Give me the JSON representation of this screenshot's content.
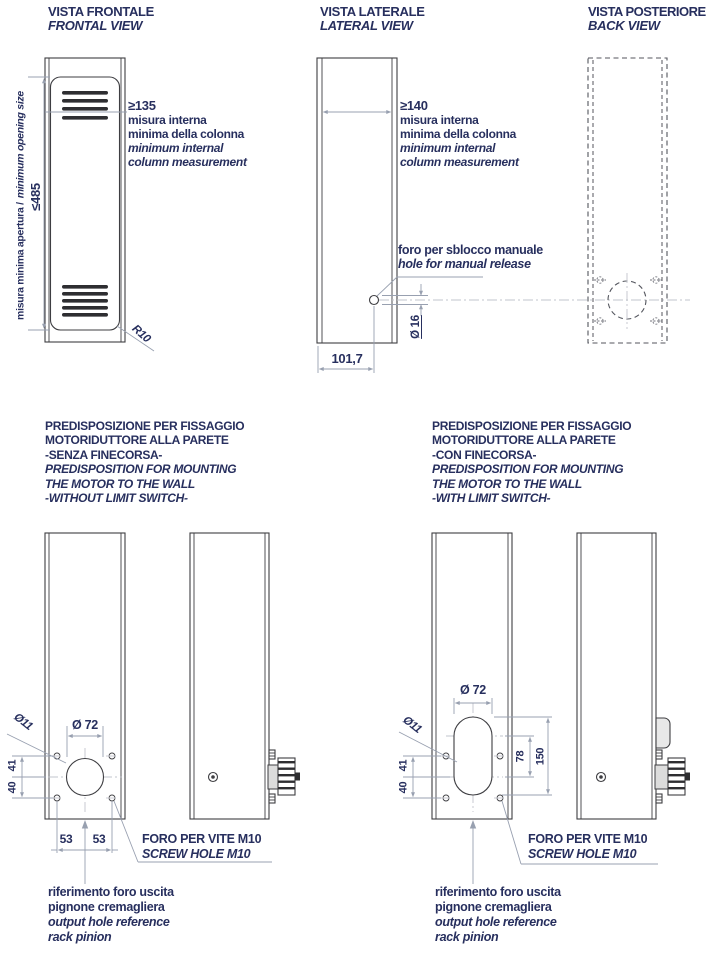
{
  "colors": {
    "text_navy": "#272f5e",
    "outline": "#3e3e42",
    "dimension_line": "#98a0b0",
    "centerline": "#c2c5cc"
  },
  "frontal": {
    "title": "VISTA FRONTALE",
    "subtitle": "FRONTAL VIEW",
    "height_dim": "≤485",
    "height_label_it": "misura minima apertura /",
    "height_label_en": "minimum opening size",
    "internal_dim": "≥135",
    "internal_note": [
      "misura interna",
      "minima della colonna",
      "minimum internal",
      "column measurement"
    ],
    "radius_label": "R10"
  },
  "lateral": {
    "title": "VISTA LATERALE",
    "subtitle": "LATERAL VIEW",
    "internal_dim": "≥140",
    "internal_note": [
      "misura interna",
      "minima della colonna",
      "minimum internal",
      "column measurement"
    ],
    "release_note_it": "foro per sblocco manuale",
    "release_note_en": "hole for manual release",
    "hole_dia": "Ø 16",
    "depth_dim": "101,7"
  },
  "back": {
    "title": "VISTA POSTERIORE",
    "subtitle": "BACK VIEW"
  },
  "mount_no_limit": {
    "title": [
      "PREDISPOSIZIONE PER FISSAGGIO",
      "MOTORIDUTTORE ALLA PARETE",
      "-SENZA FINECORSA-",
      "PREDISPOSITION FOR MOUNTING",
      "THE MOTOR TO THE WALL",
      "-WITHOUT LIMIT SWITCH-"
    ],
    "big_hole_dia": "Ø 72",
    "small_hole_dia": "Ø11",
    "upper_offset_dim": "41",
    "lower_offset_dim": "40",
    "hole_spacing_left": "53",
    "hole_spacing_right": "53",
    "screw_note_it": "FORO PER VITE M10",
    "screw_note_en": "SCREW HOLE M10",
    "pinion_note": [
      "riferimento foro uscita",
      "pignone cremagliera",
      "output hole reference",
      "rack pinion"
    ]
  },
  "mount_with_limit": {
    "title": [
      "PREDISPOSIZIONE PER FISSAGGIO",
      "MOTORIDUTTORE ALLA PARETE",
      "-CON FINECORSA-",
      "PREDISPOSITION FOR MOUNTING",
      "THE MOTOR TO THE WALL",
      "-WITH LIMIT SWITCH-"
    ],
    "big_hole_dia": "Ø 72",
    "small_hole_dia": "Ø11",
    "upper_offset_dim": "41",
    "lower_offset_dim": "40",
    "slot_centers_dim": "78",
    "slot_overall_dim": "150",
    "screw_note_it": "FORO PER VITE M10",
    "screw_note_en": "SCREW HOLE M10",
    "pinion_note": [
      "riferimento foro uscita",
      "pignone cremagliera",
      "output hole reference",
      "rack pinion"
    ]
  }
}
